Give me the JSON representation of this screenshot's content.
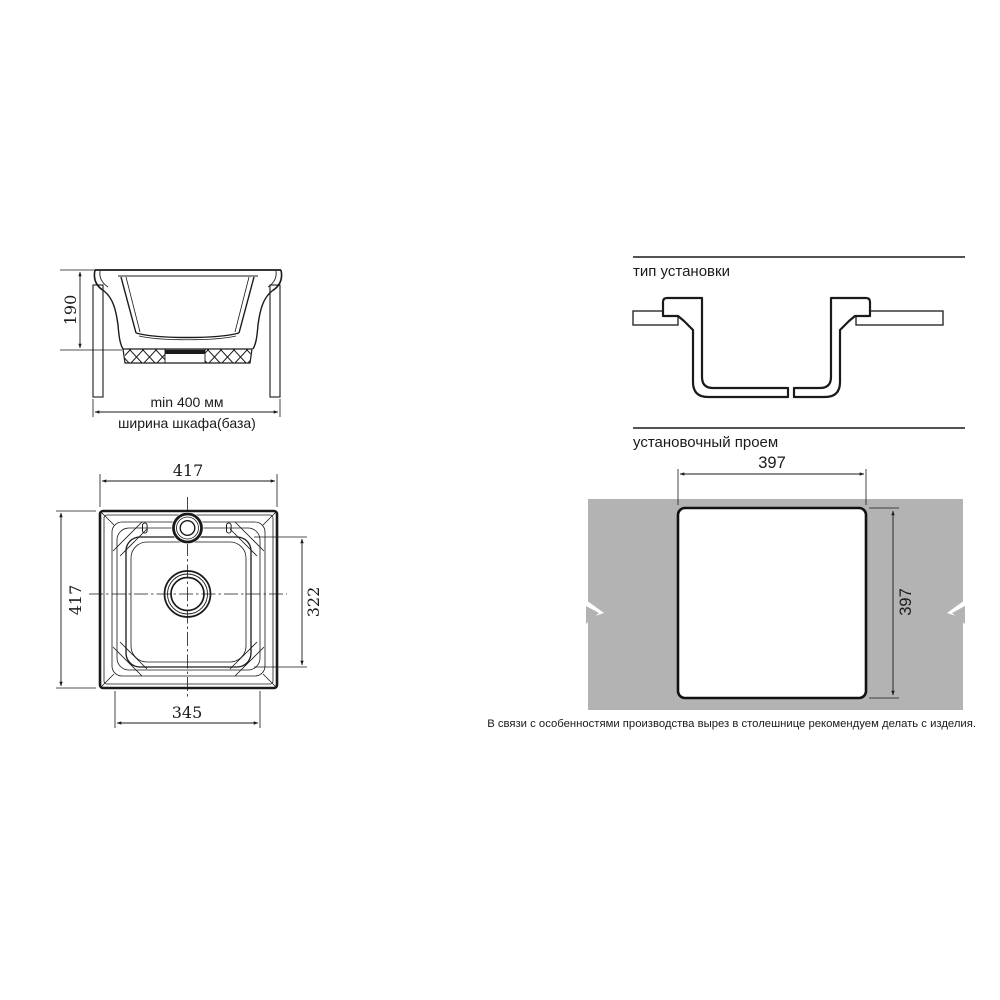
{
  "section_view": {
    "depth_label": "190",
    "min_width_label": "min 400 мм",
    "cabinet_width_label": "ширина шкафа(база)"
  },
  "installation_type": {
    "title": "тип установки"
  },
  "top_view": {
    "outer_width": "417",
    "outer_height": "417",
    "bowl_inner_height": "322",
    "bowl_inner_width": "345"
  },
  "installation_opening": {
    "title": "установочный проем",
    "cutout_width": "397",
    "cutout_height": "397",
    "note": "В связи с особенностями производства вырез в столешнице рекомендуем делать с изделия."
  },
  "colors": {
    "line": "#1a1a1a",
    "countertop": "#b3b3b3"
  }
}
